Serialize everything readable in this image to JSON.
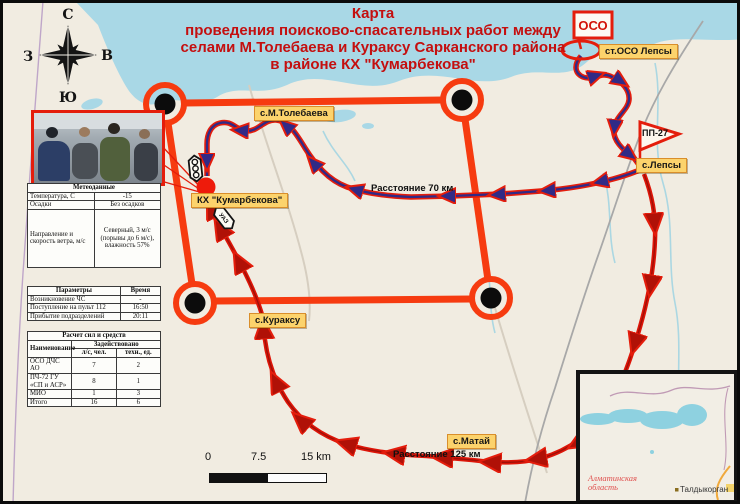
{
  "title": {
    "lines": [
      "Карта",
      "проведения поисково-спасательных работ между",
      "селами М.Толебаева и Кураксу Сарканского района",
      "в районе КХ \"Кумарбекова\""
    ]
  },
  "compass": {
    "north": "С",
    "south": "Ю",
    "west": "З",
    "east": "В"
  },
  "weather": {
    "header": "Метеоданные",
    "rows": [
      {
        "label": "Температура, С",
        "value": "-15"
      },
      {
        "label": "Осадки",
        "value": "Без осадков"
      },
      {
        "label": "Направление и скорость ветра, м/с",
        "value": "Северный, 3 м/с (порывы до 6 м/с), влажность 57%"
      }
    ]
  },
  "timeline": {
    "col_params": "Параметры",
    "col_time": "Время",
    "rows": [
      {
        "label": "Возникновение ЧС",
        "value": "-"
      },
      {
        "label": "Поступление на пульт 112",
        "value": "16:50"
      },
      {
        "label": "Прибытие подразделений",
        "value": "20:11"
      }
    ]
  },
  "forces": {
    "header": "Расчет сил и средств",
    "name_col": "Наименование",
    "involved_col": "Задействовано",
    "sub_personnel": "л/с, чел.",
    "sub_equipment": "техн., ед.",
    "rows": [
      {
        "name": "ОСО ДЧС АО",
        "personnel": "7",
        "equipment": "2"
      },
      {
        "name": "ПЧ-72 ГУ «СП и АСР»",
        "personnel": "8",
        "equipment": "1"
      },
      {
        "name": "МИО",
        "personnel": "1",
        "equipment": "3"
      },
      {
        "name": "Итого",
        "personnel": "16",
        "equipment": "6"
      }
    ]
  },
  "labels": {
    "tolebaeva": "с.М.Толебаева",
    "kumarbekova": "КХ \"Кумарбекова\"",
    "kuraksu": "с.Кураксу",
    "matay": "с.Матай",
    "lepsy": "с.Лепсы",
    "oso_lepsy": "ст.ОСО Лепсы"
  },
  "distances": {
    "d70": "Расстояние 70 км",
    "d125": "Расстояние 125 км"
  },
  "flags": {
    "oso": "ОСО",
    "pp27": "ПП-27"
  },
  "vehicles": {
    "badge_text": "УАЗ"
  },
  "scalebar": {
    "start": "0",
    "mid": "7.5",
    "end": "15 km"
  },
  "inset": {
    "region_line1": "Алматинская",
    "region_line2": "область",
    "city": "Талдыкорган"
  },
  "colors": {
    "title_red": "#c40f0f",
    "route_red": "#e41d0c",
    "route_core_navy": "#312a86",
    "search_area_red": "#f63b10",
    "label_bg": "#fcd36c",
    "water": "#a9d8e6"
  }
}
